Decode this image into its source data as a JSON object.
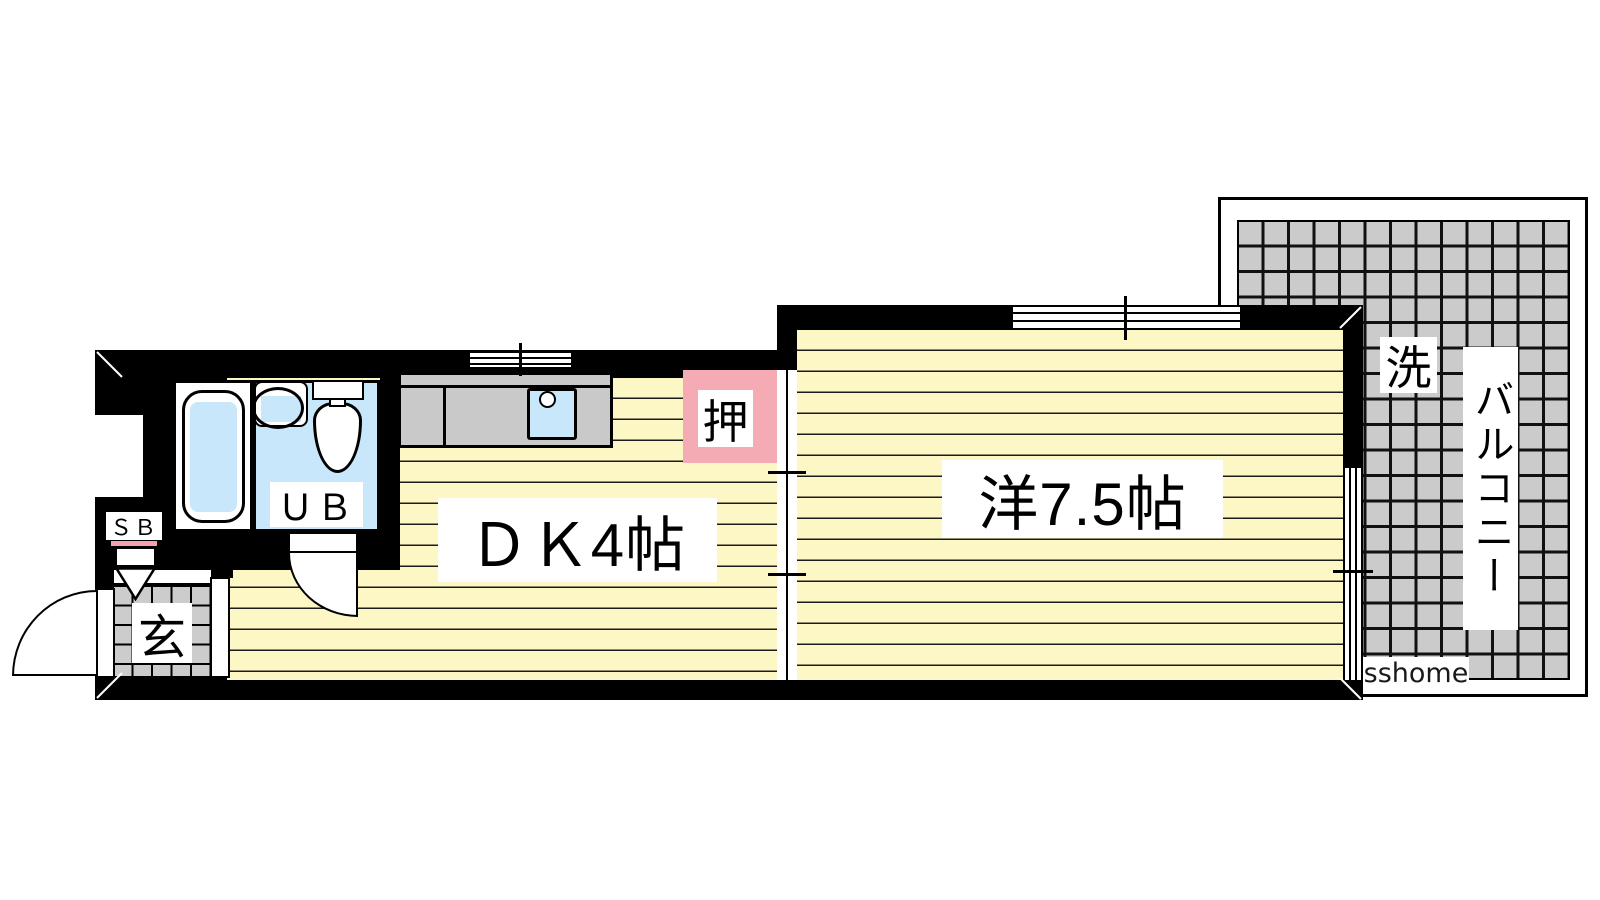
{
  "plan": {
    "dk": {
      "label": "ＤＫ4帖"
    },
    "western_room": {
      "label": "洋7.5帖"
    },
    "closet": {
      "label": "押"
    },
    "unit_bath": {
      "label": "ＵＢ"
    },
    "entrance": {
      "label": "玄"
    },
    "shoe_box": {
      "label": "ＳＢ"
    },
    "washer": {
      "label": "洗"
    },
    "balcony": {
      "label": "バルコニー"
    },
    "watermark": "sshome"
  },
  "colors": {
    "floor_yellow": "#fdf7c5",
    "closet_pink": "#f5abb4",
    "water_blue": "#c8e7fa",
    "counter_gray": "#c9c9c9",
    "tile_gray": "#cccccc",
    "balcony_gray": "#cbcbcb",
    "wall_black": "#000000",
    "sb_accent_pink": "#f2a3ac"
  }
}
